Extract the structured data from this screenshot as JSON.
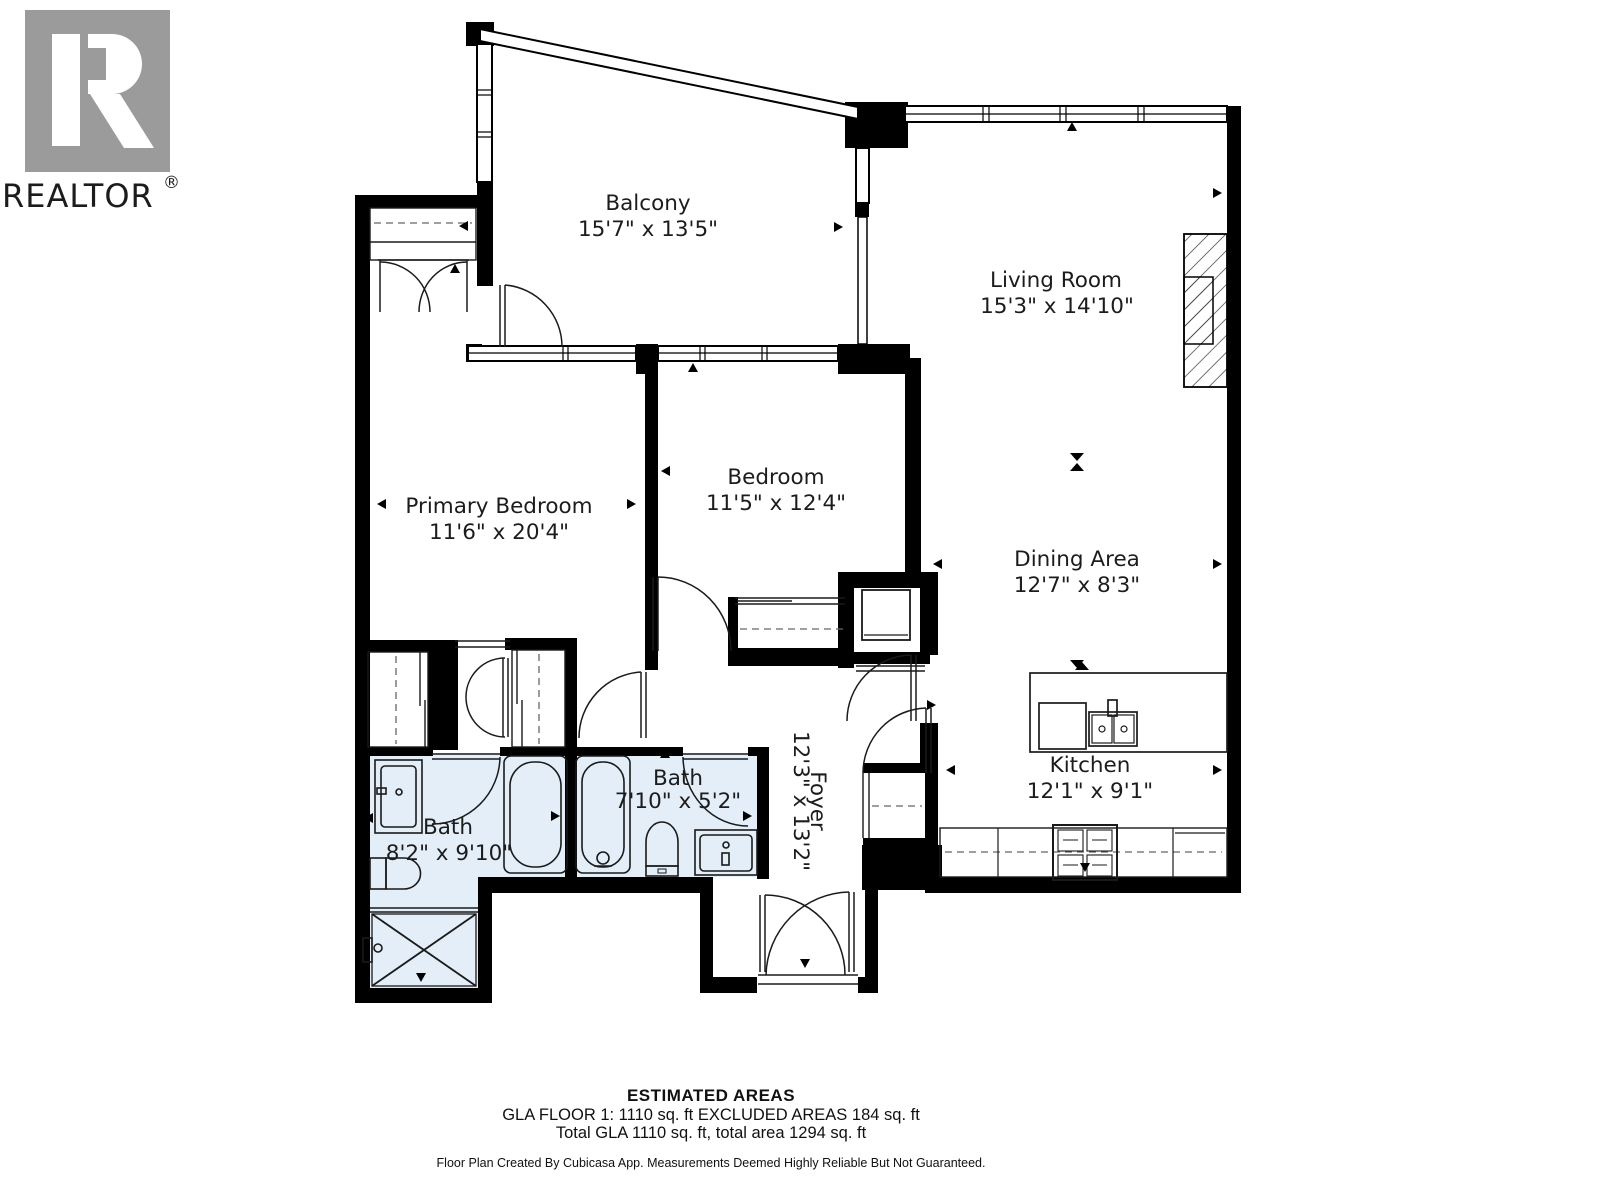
{
  "logo": {
    "brand": "REALTOR",
    "registered": "®"
  },
  "rooms": [
    {
      "id": "balcony",
      "name": "Balcony",
      "dims": "15'7\" x 13'5\""
    },
    {
      "id": "living",
      "name": "Living Room",
      "dims": "15'3\" x 14'10\""
    },
    {
      "id": "primary",
      "name": "Primary Bedroom",
      "dims": "11'6\" x 20'4\""
    },
    {
      "id": "bedroom",
      "name": "Bedroom",
      "dims": "11'5\" x 12'4\""
    },
    {
      "id": "dining",
      "name": "Dining Area",
      "dims": "12'7\" x 8'3\""
    },
    {
      "id": "kitchen",
      "name": "Kitchen",
      "dims": "12'1\" x 9'1\""
    },
    {
      "id": "bath1",
      "name": "Bath",
      "dims": "8'2\" x 9'10\""
    },
    {
      "id": "bath2",
      "name": "Bath",
      "dims": "7'10\" x 5'2\""
    },
    {
      "id": "foyer",
      "name": "Foyer",
      "dims": "12'3\" x 13'2\""
    }
  ],
  "footer": {
    "title": "ESTIMATED AREAS",
    "line1": "GLA FLOOR 1: 1110 sq. ft EXCLUDED AREAS 184 sq. ft",
    "line2": "Total GLA 1110 sq. ft, total area 1294 sq. ft",
    "disclaimer": "Floor Plan Created By Cubicasa App. Measurements Deemed Highly Reliable But Not Guaranteed."
  },
  "colors": {
    "wall": "#000000",
    "bath_fill": "#e3eef9",
    "logo_gray": "#9b9b9b",
    "text": "#1c1c1c"
  }
}
